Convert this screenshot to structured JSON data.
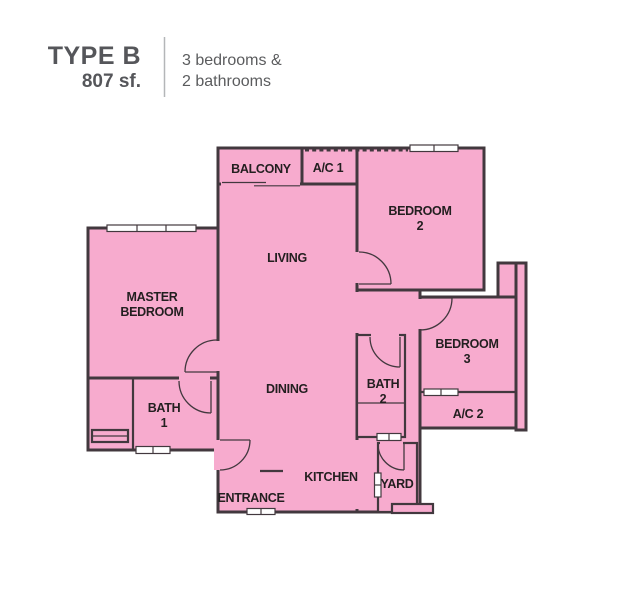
{
  "header": {
    "type_label": "TYPE B",
    "area": "807 sf.",
    "description_line1": "3 bedrooms &",
    "description_line2": "2 bathrooms"
  },
  "floor_plan": {
    "rooms": {
      "balcony": "BALCONY",
      "ac1": "A/C 1",
      "bedroom2_line1": "BEDROOM",
      "bedroom2_line2": "2",
      "living": "LIVING",
      "master_line1": "MASTER",
      "master_line2": "BEDROOM",
      "bedroom3_line1": "BEDROOM",
      "bedroom3_line2": "3",
      "dining": "DINING",
      "bath2_line1": "BATH",
      "bath2_line2": "2",
      "bath1_line1": "BATH",
      "bath1_line2": "1",
      "ac2": "A/C 2",
      "kitchen": "KITCHEN",
      "entrance": "ENTRANCE",
      "yard": "YARD"
    },
    "colors": {
      "room_fill": "#f7abce",
      "wall": "#42383e",
      "label_text": "#231f20",
      "header_text": "#55565a"
    }
  }
}
